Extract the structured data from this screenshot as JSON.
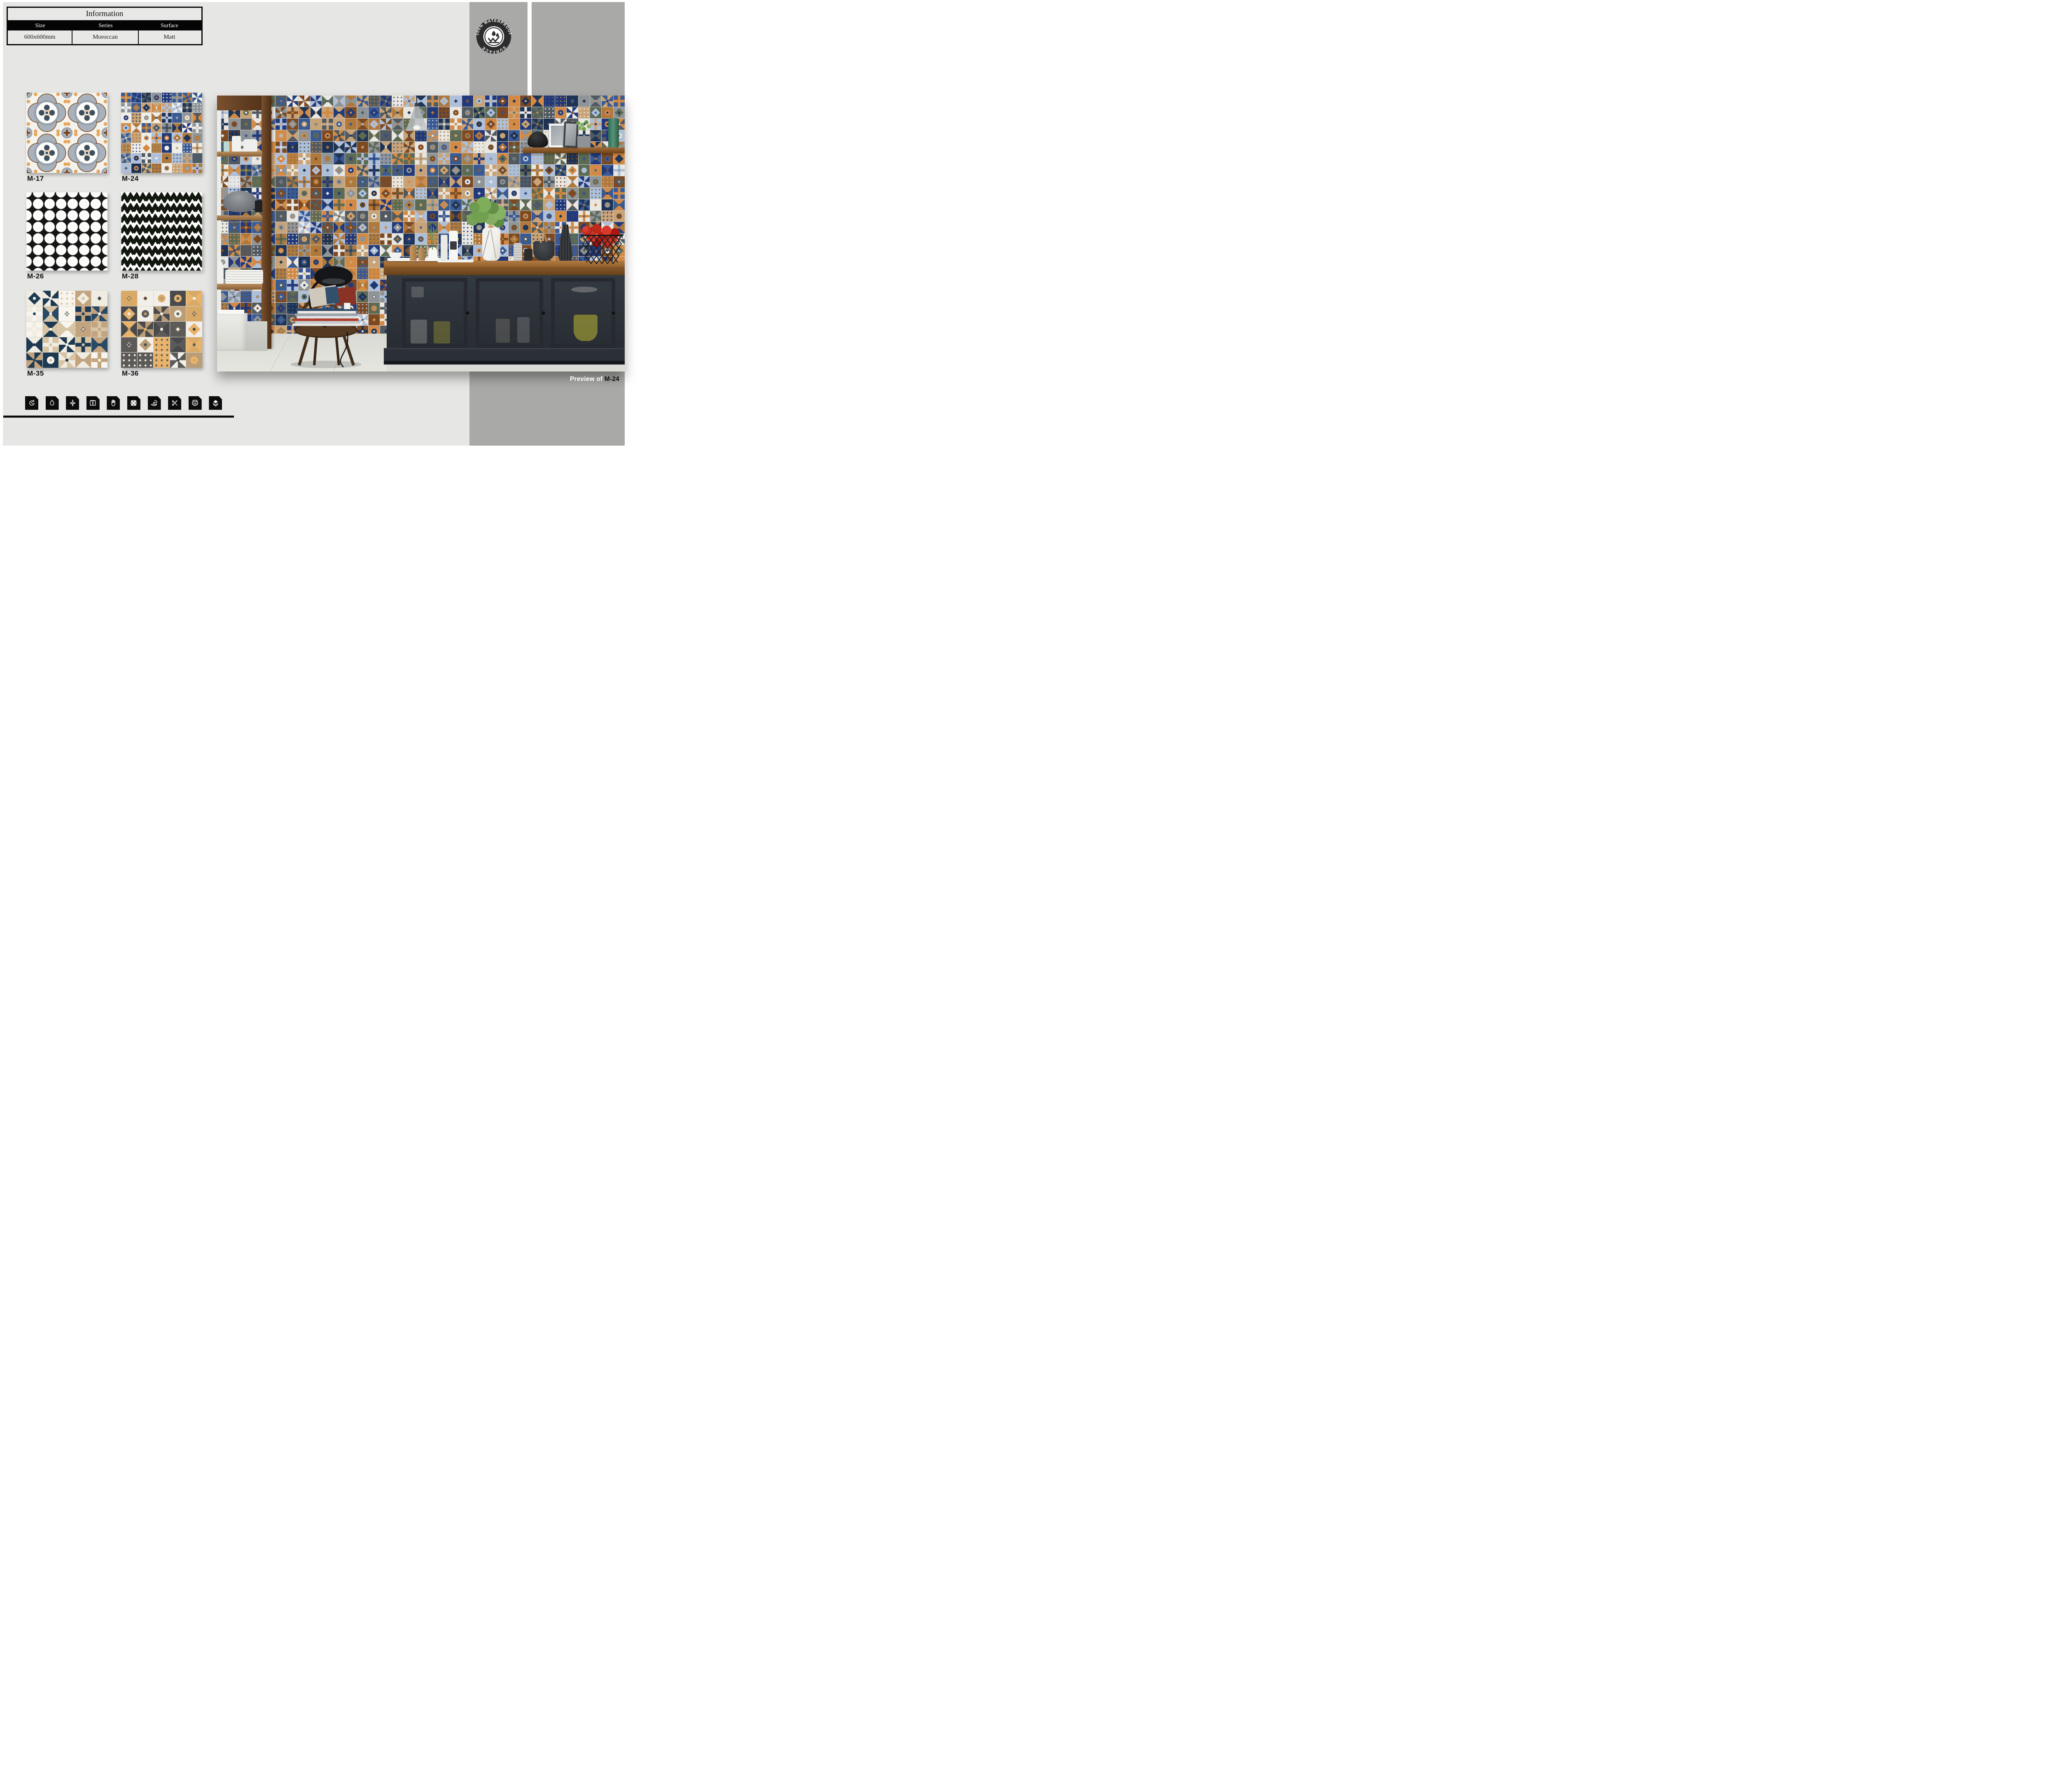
{
  "page": {
    "background": "#ffffff",
    "content_bg": "#e6e6e5",
    "panel_bg": "#a9a9a8"
  },
  "info_table": {
    "title": "Information",
    "headers": [
      "Size",
      "Series",
      "Surface"
    ],
    "values": [
      "600x600mm",
      "Moroccan",
      "Matt"
    ]
  },
  "badge": {
    "arc_text": "100% WATERPROOF",
    "bottom_text": "SURFACE",
    "accent": "#2d2d2d"
  },
  "products": [
    {
      "code": "M-17",
      "pattern": "quatrefoil-floral"
    },
    {
      "code": "M-24",
      "pattern": "moroccan-patchwork"
    },
    {
      "code": "M-26",
      "pattern": "circle-petal-black-white"
    },
    {
      "code": "M-28",
      "pattern": "chevron-black-white"
    },
    {
      "code": "M-35",
      "pattern": "navy-tan-patchwork"
    },
    {
      "code": "M-36",
      "pattern": "charcoal-peach-patchwork"
    }
  ],
  "preview": {
    "prefix": "Preview of ",
    "code": "M-24"
  },
  "feature_icons": [
    {
      "name": "color-fastness"
    },
    {
      "name": "water-resistant"
    },
    {
      "name": "compression-strength"
    },
    {
      "name": "dimension-stability"
    },
    {
      "name": "hand-crafted-look"
    },
    {
      "name": "pattern-variation"
    },
    {
      "name": "eco-friendly"
    },
    {
      "name": "easy-installation"
    },
    {
      "name": "digital-printing"
    },
    {
      "name": "layered-glaze"
    }
  ],
  "patterns": {
    "wall": {
      "cols": 35,
      "rows": 24,
      "grout": "#cfc9c0",
      "palette": [
        "#d28a45",
        "#c8a377",
        "#3a5a94",
        "#22397a",
        "#aebfda",
        "#8e9498",
        "#515a61",
        "#e9e7e2",
        "#1f3354",
        "#7c4a22",
        "#b0793c",
        "#5d6a54"
      ]
    },
    "m24": {
      "cols": 8,
      "rows": 8,
      "grout": "#e9e5dd",
      "palette": [
        "#d28a45",
        "#c8a377",
        "#3a5a94",
        "#22397a",
        "#aebfda",
        "#8e9498",
        "#515a61",
        "#efede8",
        "#1f3354",
        "#b0793c"
      ]
    },
    "m35": {
      "cols": 5,
      "rows": 5,
      "grout": "#ddd6c9",
      "palette": [
        "#1d3a52",
        "#c3a47f",
        "#f0ece2",
        "#284a66",
        "#d7c4a4",
        "#f7f5ee"
      ]
    },
    "m36": {
      "cols": 5,
      "rows": 5,
      "grout": "#ddd6c9",
      "palette": [
        "#4a4a4c",
        "#b89d77",
        "#e8b36b",
        "#f2efe8",
        "#5d5b58",
        "#d9a967"
      ]
    }
  }
}
